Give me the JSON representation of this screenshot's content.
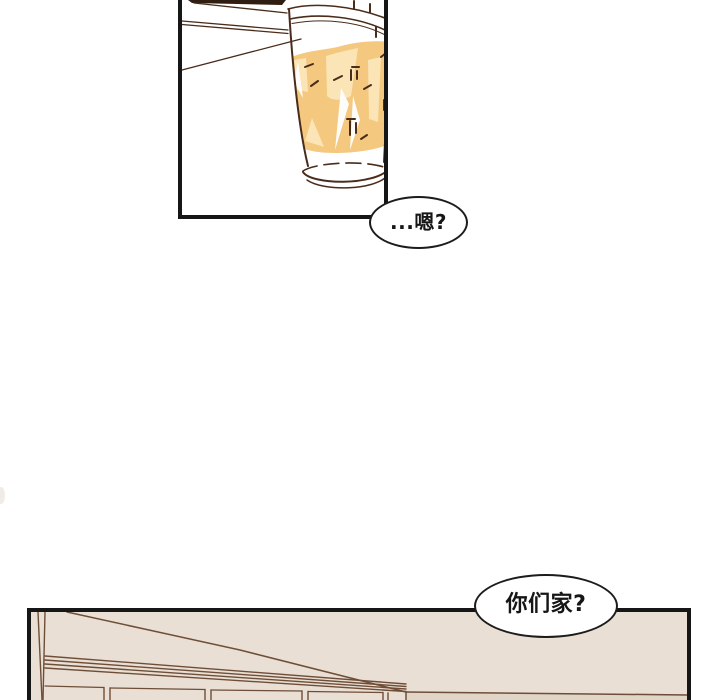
{
  "page": {
    "width": 720,
    "height": 700,
    "background": "#ffffff"
  },
  "bubbles": [
    {
      "text": "...嗯?"
    },
    {
      "text": "你们家?"
    }
  ],
  "panels": [
    {
      "name": "drink-cup-panel",
      "content": "plastic cup of iced tea tipping at a table edge"
    },
    {
      "name": "room-interior-panel",
      "content": "room interior with ceiling lines and window moldings"
    }
  ],
  "colors": {
    "panel_border": "#161616",
    "bubble_border": "#1c1c1c",
    "cup_outline": "#4a2c1a",
    "table_dark": "#2f1d12",
    "drink_fill": "#f4c87e",
    "drink_light": "#fbe4b6",
    "drink_highlight": "#ffffff",
    "room_line": "#6f4e38",
    "room_bg": "#e9dfd4",
    "room_wall_dark": "#ddd0c2"
  }
}
